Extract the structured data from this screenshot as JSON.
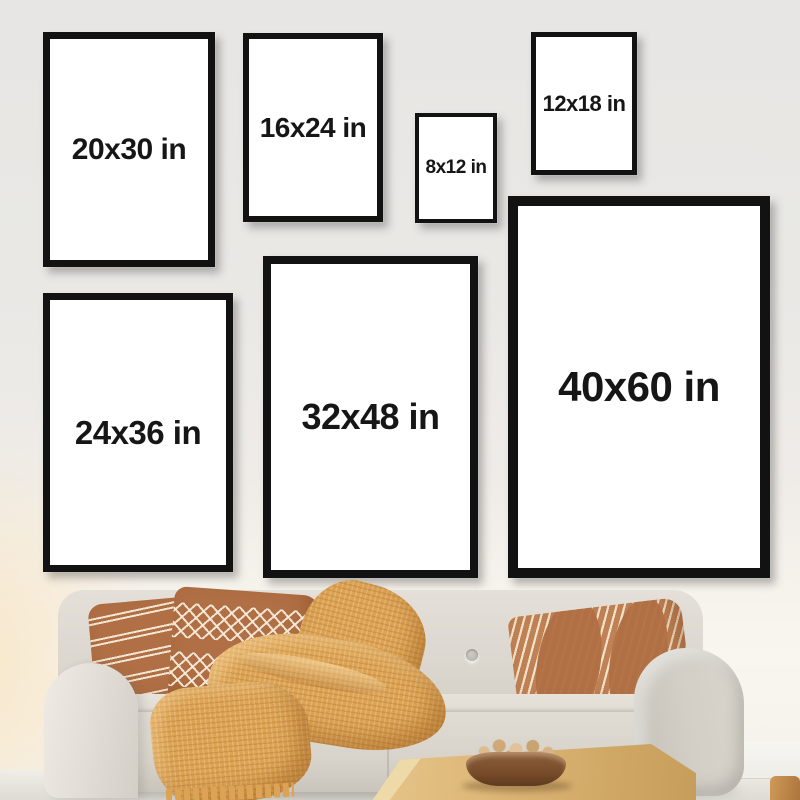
{
  "frames": [
    {
      "id": "20x30",
      "label": "20x30 in",
      "width_in": 20,
      "height_in": 30
    },
    {
      "id": "16x24",
      "label": "16x24 in",
      "width_in": 16,
      "height_in": 24
    },
    {
      "id": "8x12",
      "label": "8x12 in",
      "width_in": 8,
      "height_in": 12
    },
    {
      "id": "12x18",
      "label": "12x18 in",
      "width_in": 12,
      "height_in": 18
    },
    {
      "id": "24x36",
      "label": "24x36 in",
      "width_in": 24,
      "height_in": 36
    },
    {
      "id": "32x48",
      "label": "32x48 in",
      "width_in": 32,
      "height_in": 48
    },
    {
      "id": "40x60",
      "label": "40x60 in",
      "width_in": 40,
      "height_in": 60
    }
  ],
  "colors": {
    "frame_border": "#121212",
    "frame_face": "#ffffff",
    "wall_top": "#e7e6e4",
    "wall_bottom": "#f8f4ee",
    "sofa": "#d9d5cd",
    "pillow_rust": "#b06f44",
    "pillow_cream": "#f3e6d2",
    "throw": "#dca355",
    "table_wood": "#ddb778",
    "bowl": "#7a4e2c",
    "floor": "#e6e3dd"
  }
}
